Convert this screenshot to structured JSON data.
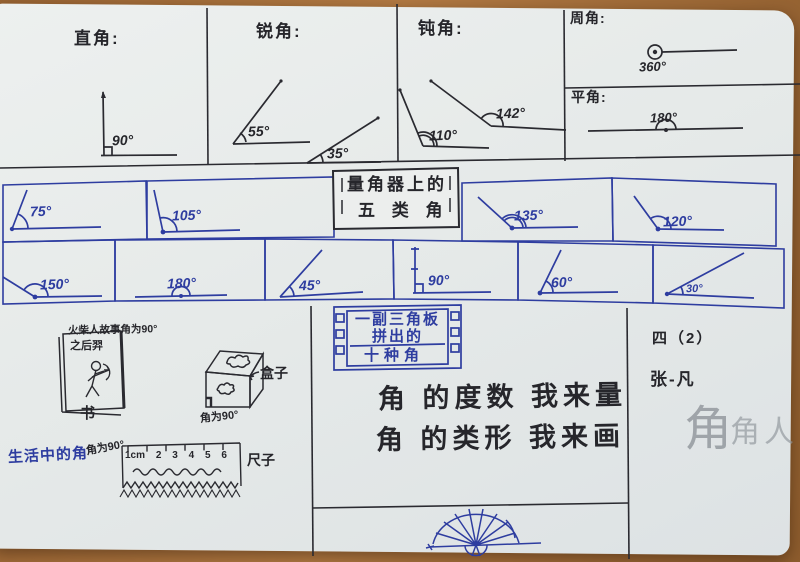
{
  "top": {
    "right_angle": {
      "title": "直角:",
      "deg": "90°"
    },
    "acute": {
      "title": "锐角:",
      "deg1": "55°",
      "deg2": "35°"
    },
    "obtuse": {
      "title": "钝角:",
      "deg1": "110°",
      "deg2": "142°"
    },
    "full": {
      "title": "周角:",
      "deg": "360°"
    },
    "straight": {
      "title": "平角:",
      "deg": "180°"
    }
  },
  "protractor": {
    "title_line1": "量角器上的",
    "title_line2": "五 类 角",
    "row1": [
      "75°",
      "105°",
      "135°",
      "120°"
    ],
    "row2": [
      "150°",
      "180°",
      "45°",
      "90°",
      "60°",
      "30°"
    ]
  },
  "bottom_left": {
    "book_note_line1": "火柴人故事角为90°",
    "book_note_line2": "之后羿",
    "book_label": "书",
    "box_label": "盒子",
    "box_note": "角为90°",
    "life_title": "生活中的角",
    "ruler_note": "角为90°",
    "ruler_scale": [
      "1cm",
      "2",
      "3",
      "4",
      "5",
      "6"
    ],
    "ruler_label": "尺子"
  },
  "bottom_middle": {
    "board_line1": "一副三角板",
    "board_line2": "拼出的",
    "board_line3": "十种角",
    "slogan_line1": "角 的度数 我来量",
    "slogan_line2": "角 的类形 我来画"
  },
  "bottom_right": {
    "class_name": "四（2）",
    "student_name": "张-凡",
    "pencil_doodle_large": "角",
    "pencil_doodle_small": "角人"
  }
}
